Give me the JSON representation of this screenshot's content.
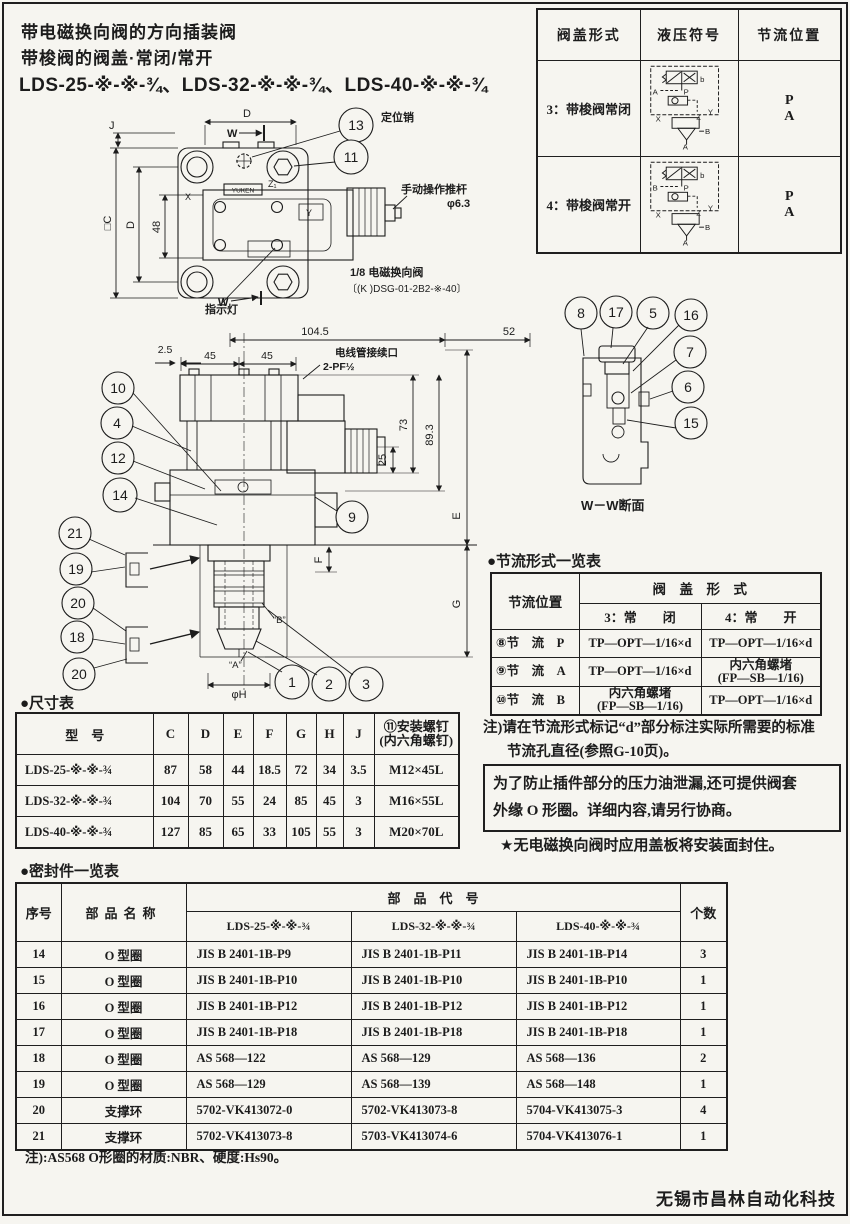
{
  "page": {
    "title_line1": "带电磁换向阀的方向插装阀",
    "title_line2": "带梭阀的阀盖·常闭/常开",
    "title_line3": "LDS-25-※-※-¾、LDS-32-※-※-¾、LDS-40-※-※-¾",
    "footer": "无锡市昌林自动化科技"
  },
  "cover_table": {
    "headers": [
      "阀盖形式",
      "液压符号",
      "节流位置"
    ],
    "rows": [
      {
        "form": "3：带梭阀常闭",
        "pos_top": "P",
        "pos_bottom": "A",
        "sym": {
          "side": "A",
          "b": "b",
          "p": "P",
          "x": "X",
          "z": "Z",
          "y": "Y",
          "bp": "B",
          "ap": "A"
        }
      },
      {
        "form": "4：带梭阀常开",
        "pos_top": "P",
        "pos_bottom": "A",
        "sym": {
          "side": "B",
          "b": "b",
          "p": "P",
          "x": "X",
          "z": "Z",
          "y": "Y",
          "bp": "B",
          "ap": "A"
        }
      }
    ]
  },
  "plan": {
    "callout_13": "13",
    "callout_11": "11",
    "pin_label": "定位销",
    "rod_label": "手动操作推杆",
    "rod_dia": "φ6.3",
    "indicator_label": "指示灯",
    "valve_label": "1/8 电磁换向阀",
    "valve_model": "〔(K )DSG-01-2B2-※-40〕",
    "space_label": "电磁铁装拆空间",
    "brand": "YUKEN",
    "dim_d_top": "D",
    "dim_w_top": "W",
    "dim_w_bottom": "W",
    "dim_j": "J",
    "dim_c": "□C",
    "dim_d_left": "D",
    "dim_48": "48",
    "port_x": "X",
    "port_y": "Y",
    "port_z": "Z₁"
  },
  "front": {
    "dim_104_5": "104.5",
    "dim_52": "52",
    "dim_2_5": "2.5",
    "dim_45a": "45",
    "dim_45b": "45",
    "conduit_label": "电线管接续口",
    "conduit_size": "2-PF½",
    "dim_73": "73",
    "dim_89_3": "89.3",
    "dim_25": "25",
    "dim_e": "E",
    "dim_f": "F",
    "dim_g": "G",
    "dim_h": "φH",
    "label_a": "“A”",
    "label_b": "“B”",
    "callouts_upper": [
      "10",
      "4",
      "12",
      "14"
    ],
    "callouts_lower": [
      "21",
      "19",
      "20",
      "18",
      "20"
    ],
    "callout_9": "9",
    "callouts_bottom": [
      "1",
      "2",
      "3"
    ]
  },
  "section": {
    "callouts": [
      "8",
      "17",
      "5",
      "16",
      "7",
      "6",
      "15"
    ],
    "caption": "W－W断面"
  },
  "dim_table": {
    "title": "●尺寸表",
    "col_model": "型　号",
    "cols": [
      "C",
      "D",
      "E",
      "F",
      "G",
      "H",
      "J"
    ],
    "col_screw_1": "⑪安装螺钉",
    "col_screw_2": "(内六角螺钉)",
    "rows": [
      {
        "model": "LDS-25-※-※-¾",
        "c": "87",
        "d": "58",
        "e": "44",
        "f": "18.5",
        "g": "72",
        "h": "34",
        "j": "3.5",
        "screw": "M12×45L"
      },
      {
        "model": "LDS-32-※-※-¾",
        "c": "104",
        "d": "70",
        "e": "55",
        "f": "24",
        "g": "85",
        "h": "45",
        "j": "3",
        "screw": "M16×55L"
      },
      {
        "model": "LDS-40-※-※-¾",
        "c": "127",
        "d": "85",
        "e": "65",
        "f": "33",
        "g": "105",
        "h": "55",
        "j": "3",
        "screw": "M20×70L"
      }
    ]
  },
  "throttle_table": {
    "title": "●节流形式一览表",
    "col_pos": "节流位置",
    "span_header": "阀　盖　形　式",
    "sub_closed": "3：常　　闭",
    "sub_open": "4：常　　开",
    "rows": [
      {
        "pos": "⑧节　流　P",
        "closed": "TP—OPT—1/16×d",
        "open": "TP—OPT—1/16×d"
      },
      {
        "pos": "⑨节　流　A",
        "closed": "TP—OPT—1/16×d",
        "open": "内六角螺堵\n(FP—SB—1/16)"
      },
      {
        "pos": "⑩节　流　B",
        "closed": "内六角螺堵\n(FP—SB—1/16)",
        "open": "TP—OPT—1/16×d"
      }
    ]
  },
  "notes": {
    "throttle_line1": "注)请在节流形式标记“d”部分标注实际所需要的标准",
    "throttle_line2": "节流孔直径(参照G-10页)。",
    "boxed_line1": "为了防止插件部分的压力油泄漏,还可提供阀套",
    "boxed_line2": "外缘 O 形圈。详细内容,请另行协商。",
    "star": "★无电磁换向阀时应用盖板将安装面封住。",
    "seal": "注):AS568 O形圈的材质:NBR、硬度:Hs90。"
  },
  "seal_table": {
    "title": "●密封件一览表",
    "col_no": "序号",
    "col_name": "部品名称",
    "col_code": "部　品　代　号",
    "col_qty": "个数",
    "models": [
      "LDS-25-※-※-¾",
      "LDS-32-※-※-¾",
      "LDS-40-※-※-¾"
    ],
    "rows": [
      {
        "no": "14",
        "name": "O 型圈",
        "c1": "JIS B 2401-1B-P9",
        "c2": "JIS B 2401-1B-P11",
        "c3": "JIS B 2401-1B-P14",
        "qty": "3"
      },
      {
        "no": "15",
        "name": "O 型圈",
        "c1": "JIS B 2401-1B-P10",
        "c2": "JIS B 2401-1B-P10",
        "c3": "JIS B 2401-1B-P10",
        "qty": "1"
      },
      {
        "no": "16",
        "name": "O 型圈",
        "c1": "JIS B 2401-1B-P12",
        "c2": "JIS B 2401-1B-P12",
        "c3": "JIS B 2401-1B-P12",
        "qty": "1"
      },
      {
        "no": "17",
        "name": "O 型圈",
        "c1": "JIS B 2401-1B-P18",
        "c2": "JIS B 2401-1B-P18",
        "c3": "JIS B 2401-1B-P18",
        "qty": "1"
      },
      {
        "no": "18",
        "name": "O 型圈",
        "c1": "AS 568—122",
        "c2": "AS 568—129",
        "c3": "AS 568—136",
        "qty": "2"
      },
      {
        "no": "19",
        "name": "O 型圈",
        "c1": "AS 568—129",
        "c2": "AS 568—139",
        "c3": "AS 568—148",
        "qty": "1"
      },
      {
        "no": "20",
        "name": "支撑环",
        "c1": "5702-VK413072-0",
        "c2": "5702-VK413073-8",
        "c3": "5704-VK413075-3",
        "qty": "4"
      },
      {
        "no": "21",
        "name": "支撑环",
        "c1": "5702-VK413073-8",
        "c2": "5703-VK413074-6",
        "c3": "5704-VK413076-1",
        "qty": "1"
      }
    ]
  }
}
